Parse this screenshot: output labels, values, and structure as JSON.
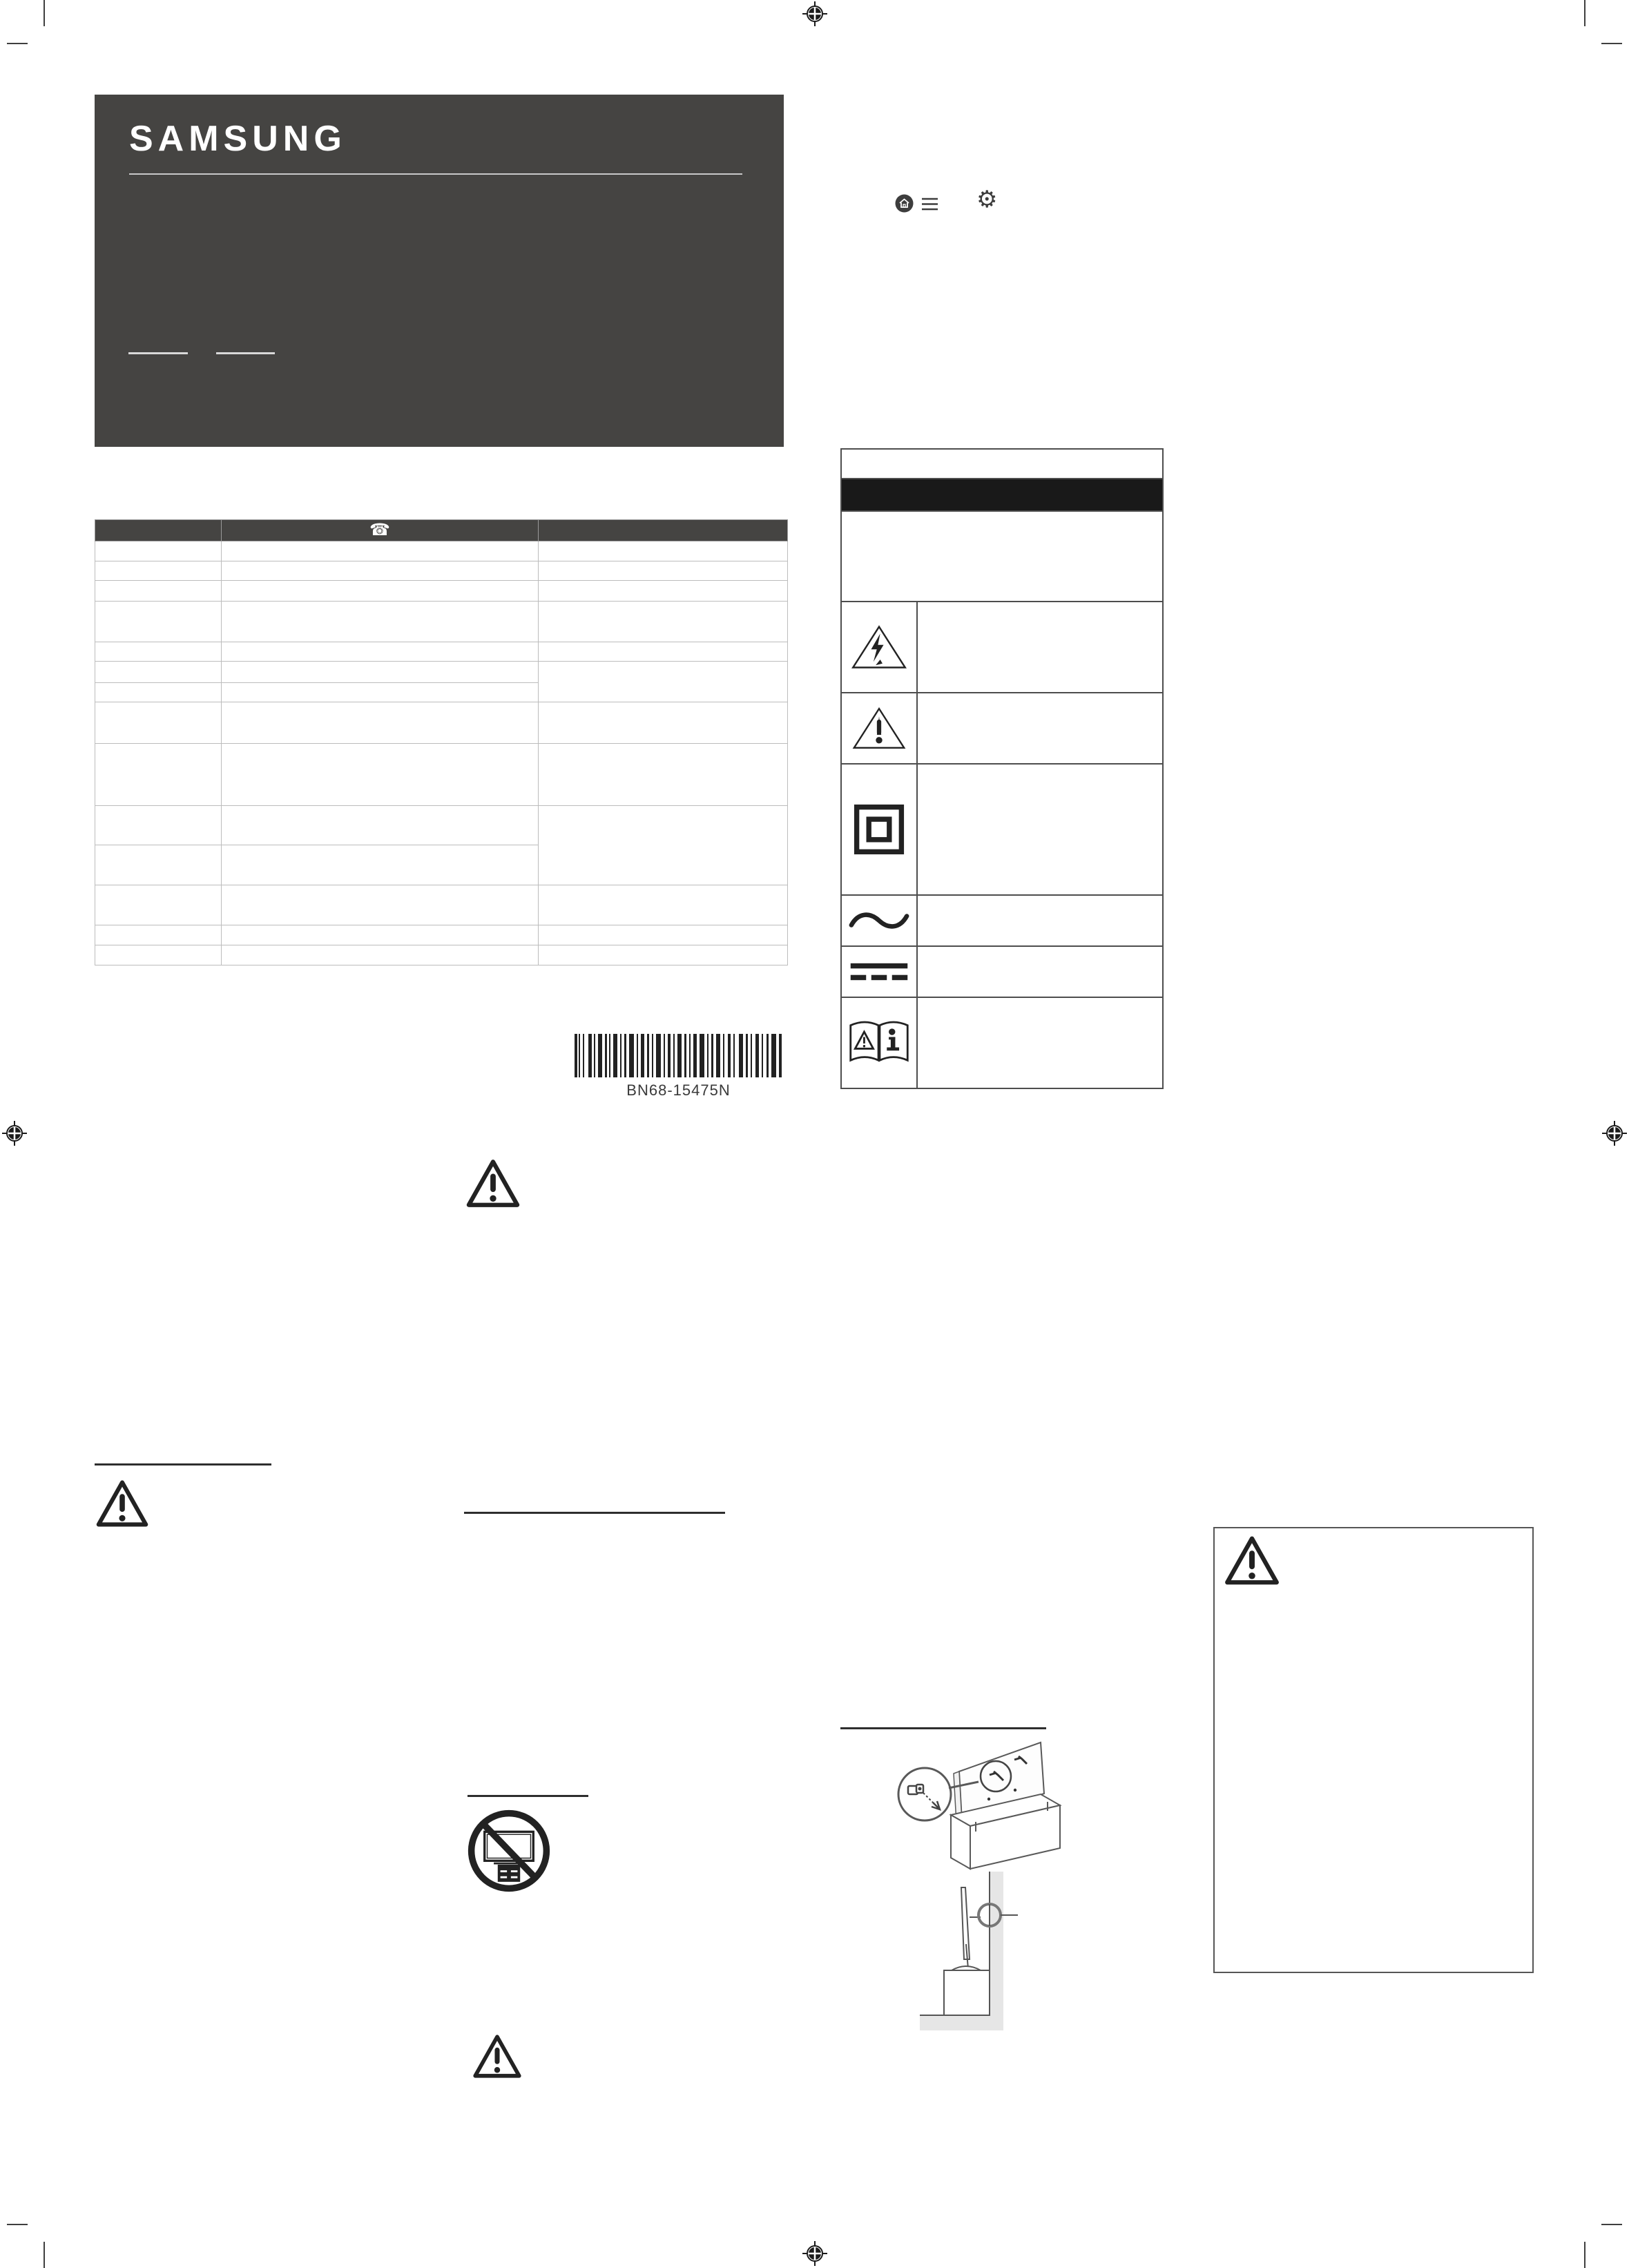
{
  "document": {
    "kind": "printed quick setup guide page (print proof with registration marks)",
    "background_color": "#ffffff"
  },
  "brand": {
    "logo_text": "SAMSUNG",
    "box_color": "#454442",
    "logo_color": "#ffffff"
  },
  "top_icons": {
    "home_icon_name": "home-button",
    "menu_icon_name": "menu-hamburger",
    "settings_icon_name": "settings-gear",
    "gear_glyph": "⚙",
    "color": "#3d3d3d"
  },
  "contact_table": {
    "header_icon": "telephone",
    "phone_glyph": "☎",
    "header_color": "#454442",
    "column_count": 3,
    "data_row_count": 14,
    "cells_text": ""
  },
  "barcode": {
    "label": "BN68-15475N",
    "bar_color": "#222222"
  },
  "safety_symbols_table": {
    "border_color": "#4d4d4d",
    "band_color": "#191919",
    "rows": [
      {
        "symbol": "none",
        "description": ""
      },
      {
        "symbol": "black-title-band",
        "description": ""
      },
      {
        "symbol": "none",
        "description": ""
      },
      {
        "symbol": "high-voltage-triangle",
        "description": ""
      },
      {
        "symbol": "caution-exclamation-triangle",
        "description": ""
      },
      {
        "symbol": "class-ii-double-insulation",
        "description": ""
      },
      {
        "symbol": "alternating-current",
        "description": ""
      },
      {
        "symbol": "direct-current",
        "description": ""
      },
      {
        "symbol": "refer-to-instruction-manual",
        "description": ""
      }
    ]
  },
  "warnings": {
    "triangle_icon_name": "warning-exclamation-triangle",
    "prohibition_icon_name": "no-tv-on-unstable-furniture",
    "count_of_standalone_triangles": 4
  },
  "illustrations": {
    "first": "tv-panel-leaning-on-box-with-bracket-screw-magnifier",
    "second": "tv-on-cabinet-anchored-to-wall",
    "line_color": "#595959",
    "shade_color": "#e6e6e6"
  },
  "print_marks": {
    "registration_mark": "circle-crosshair",
    "positions": [
      "top-center",
      "left-middle",
      "right-middle",
      "bottom-center"
    ],
    "corner_crop_marks": 4
  }
}
